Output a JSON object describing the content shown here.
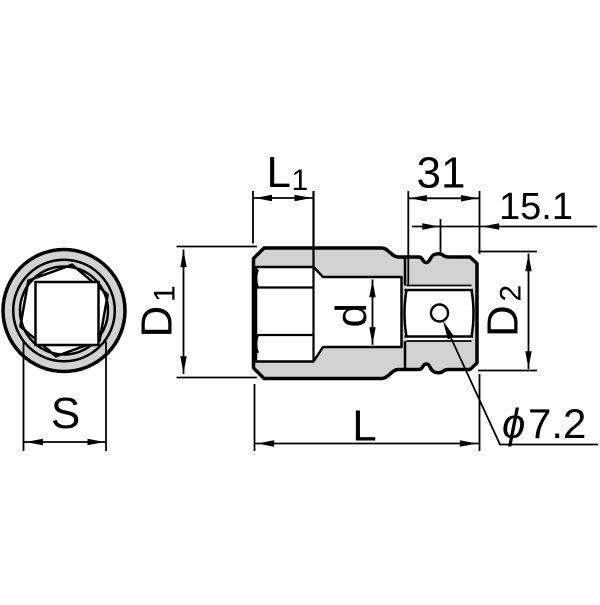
{
  "drawing": {
    "type": "socket dimensional diagram",
    "colors": {
      "body_fill": "#d2d2d2",
      "line": "#000000",
      "background": "#ffffff"
    },
    "front_view": {
      "size_label": "S"
    },
    "side_view": {
      "socket_depth": {
        "main": "L",
        "sub": "1"
      },
      "drive_section_length": "31",
      "drive_end_length": "15.1",
      "outer_diameter": {
        "main": "D",
        "sub": "1"
      },
      "drive_diameter": {
        "main": "D",
        "sub": "2"
      },
      "bore_diameter": "d",
      "overall_length": "L",
      "pin_hole": {
        "symbol": "ϕ",
        "value": "7.2"
      }
    }
  }
}
